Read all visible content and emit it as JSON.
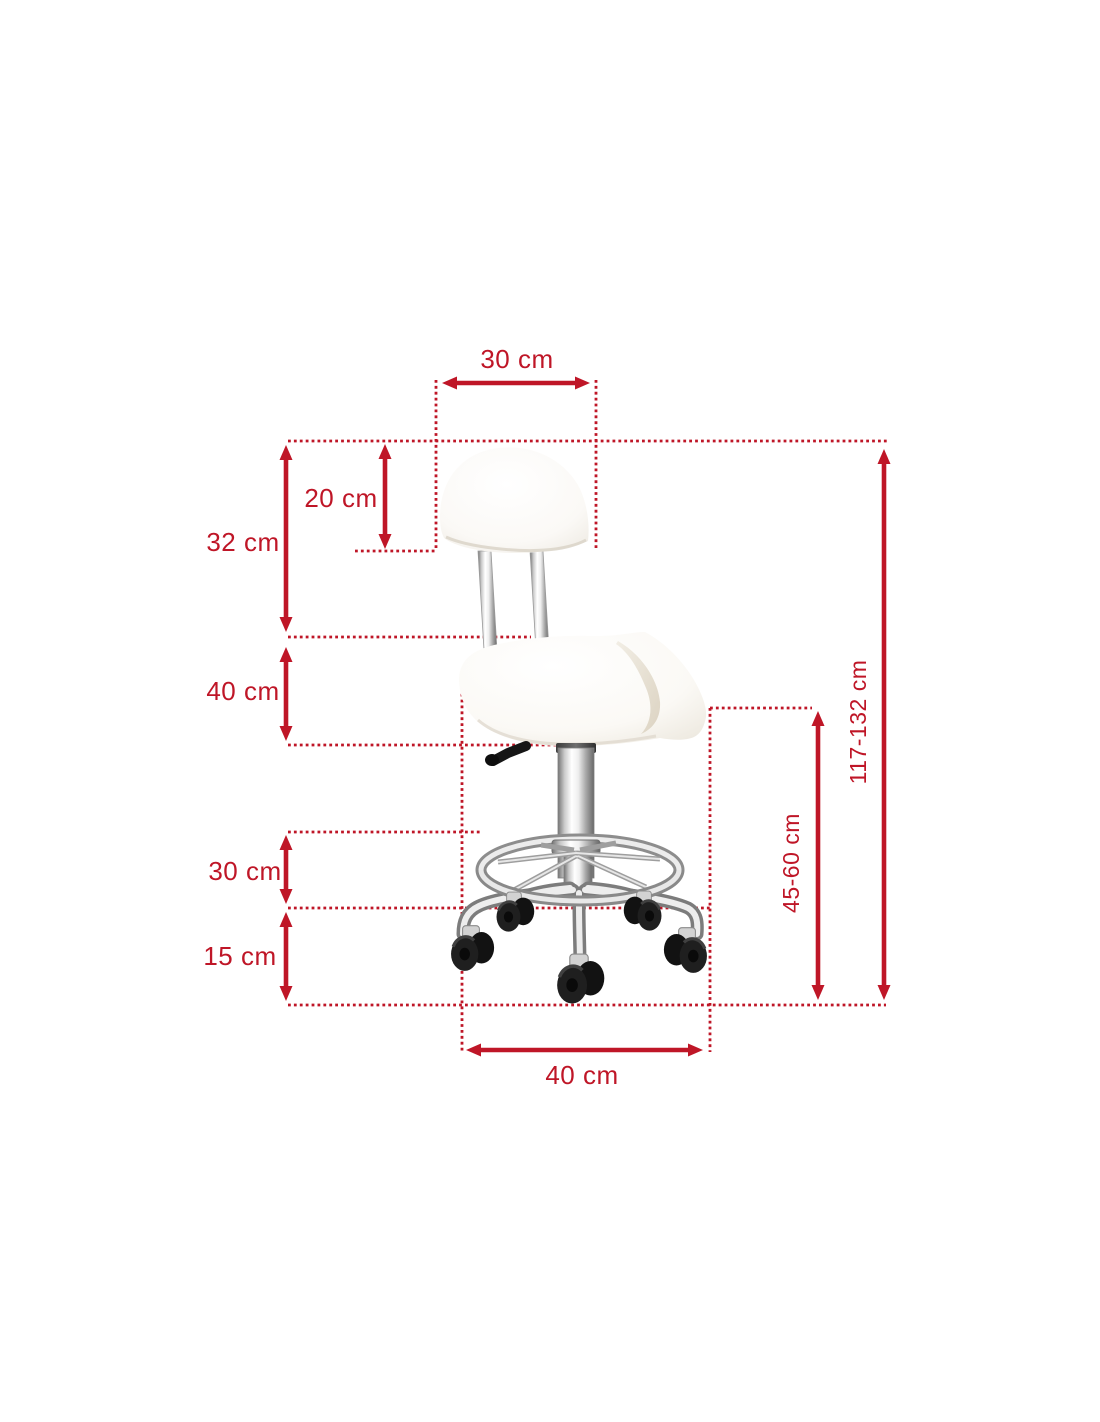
{
  "colors": {
    "dimension_red": "#bf1627",
    "background": "#ffffff"
  },
  "illustration": {
    "name": "saddle-stool-with-backrest-casters"
  },
  "dimensions": {
    "backrest_width": {
      "label": "30 cm"
    },
    "backrest_height": {
      "label": "20 cm"
    },
    "back_section_height": {
      "label": "32 cm"
    },
    "seat_section_height": {
      "label": "40 cm"
    },
    "footrest_height": {
      "label": "30 cm"
    },
    "base_height": {
      "label": "15 cm"
    },
    "base_width": {
      "label": "40 cm"
    },
    "seat_height": {
      "label": "45-60 cm"
    },
    "total_height": {
      "label": "117-132 cm"
    }
  }
}
